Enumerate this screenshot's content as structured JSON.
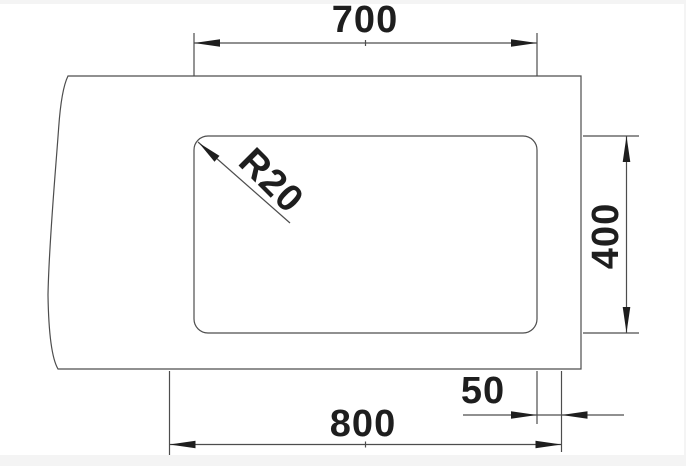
{
  "page": {
    "background_color": "#f4f4f4",
    "canvas_color": "#ffffff"
  },
  "drawing": {
    "description": "Technical dimension drawing of a rectangular sink cutout in a countertop",
    "colors": {
      "line": "#4d4d4d",
      "text": "#1e1e1e"
    },
    "dimensions": {
      "bowl_width": "700",
      "bowl_height": "400",
      "corner_radius": "R20",
      "edge_offset": "50",
      "cutout_width": "800"
    }
  }
}
